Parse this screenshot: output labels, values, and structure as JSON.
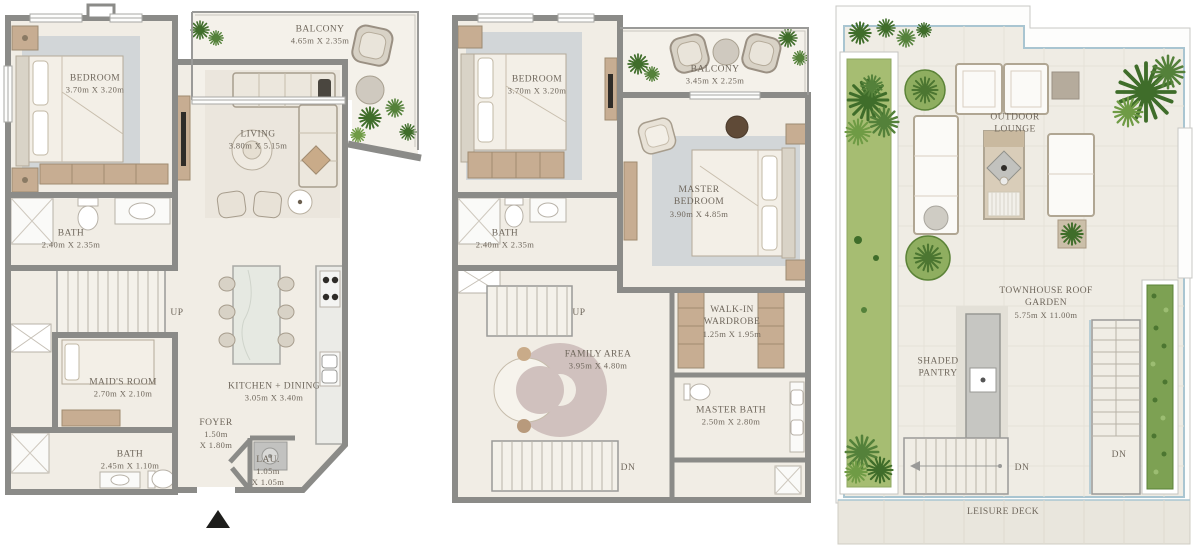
{
  "colors": {
    "wall": "#8b8b88",
    "floor": "#f1ede5",
    "balcony_floor": "#f4f1ea",
    "wood": "#c7ad92",
    "rug_blue": "#c7ced3",
    "rug_mauve": "#d0c1be",
    "lawn_green": "#a6bd72",
    "hedge_green": "#7da153",
    "plant_green": "#3f6d2a",
    "glass_blue": "#a9c5d1",
    "text": "#6f675c"
  },
  "stair_labels": {
    "up": "UP",
    "dn": "DN"
  },
  "plans": {
    "ground_floor": {
      "rooms": {
        "bedroom": {
          "name": "BEDROOM",
          "dims": "3.70m X 3.20m"
        },
        "balcony": {
          "name": "BALCONY",
          "dims": "4.65m X 2.35m"
        },
        "living": {
          "name": "LIVING",
          "dims": "3.80m X 5.15m"
        },
        "bath": {
          "name": "BATH",
          "dims": "2.40m X 2.35m"
        },
        "maids_room": {
          "name": "MAID'S ROOM",
          "dims": "2.70m X 2.10m"
        },
        "kitchen_dining": {
          "name": "KITCHEN + DINING",
          "dims": "3.05m X 3.40m"
        },
        "foyer": {
          "name": "FOYER",
          "dims_line1": "1.50m",
          "dims_line2": "X 1.80m"
        },
        "guest_bath": {
          "name": "BATH",
          "dims": "2.45m X 1.10m"
        },
        "laundry": {
          "name": "LAU.",
          "dims_line1": "1.05m",
          "dims_line2": "X 1.05m"
        }
      }
    },
    "first_floor": {
      "rooms": {
        "bedroom": {
          "name": "BEDROOM",
          "dims": "3.70m X 3.20m"
        },
        "balcony": {
          "name": "BALCONY",
          "dims": "3.45m X 2.25m"
        },
        "master_bedroom": {
          "name": "MASTER BEDROOM",
          "dims": "3.90m X 4.85m"
        },
        "bath": {
          "name": "BATH",
          "dims": "2.40m X 2.35m"
        },
        "family_area": {
          "name": "FAMILY AREA",
          "dims": "3.95m X 4.80m"
        },
        "walk_in_wardrobe": {
          "name": "WALK-IN WARDROBE",
          "dims": "1.25m X 1.95m"
        },
        "master_bath": {
          "name": "MASTER BATH",
          "dims": "2.50m X 2.80m"
        }
      }
    },
    "roof": {
      "rooms": {
        "outdoor_lounge": {
          "name": "OUTDOOR LOUNGE"
        },
        "roof_garden": {
          "name": "TOWNHOUSE ROOF GARDEN",
          "dims": "5.75m X 11.00m"
        },
        "shaded_pantry": {
          "name": "SHADED PANTRY"
        },
        "leisure_deck": {
          "name": "LEISURE DECK"
        }
      }
    }
  }
}
